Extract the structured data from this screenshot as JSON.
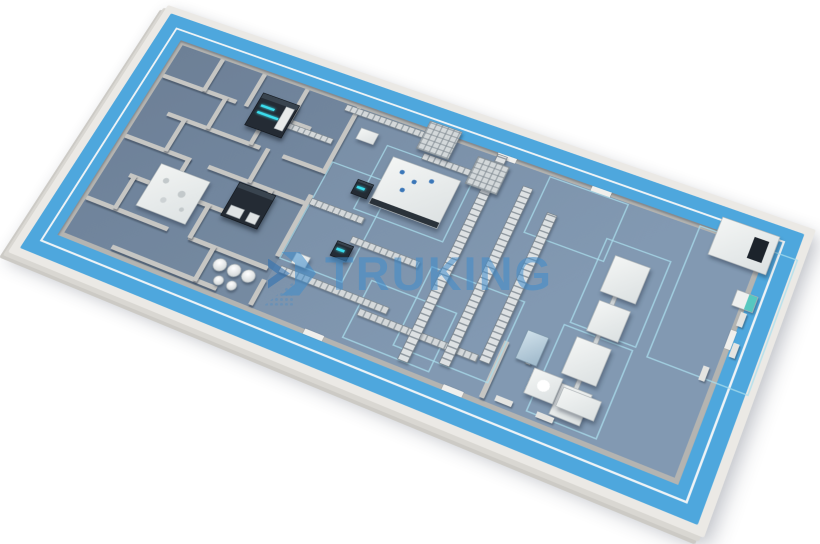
{
  "watermark": {
    "text": "TRUKING",
    "logo_icon": "truking-logo-icon"
  },
  "colors": {
    "walkway": "#4ea7dd",
    "floor-light": "#8299b2",
    "floor-dark": "#74889f",
    "slab": "#ebe9e5",
    "wall": "#c6c6c3",
    "machine-white": "#eef0ef",
    "machine-dark": "#242b34",
    "accent-cyan": "#3bdcec",
    "marking": "#a9ddec",
    "steel": "#cdd2d4",
    "watermark": "#3f8ccc"
  },
  "plan": {
    "corners_screen": {
      "nw": [
        168,
        5
      ],
      "ne": [
        816,
        230
      ],
      "sw": [
        8,
        252
      ],
      "se": [
        704,
        538
      ]
    },
    "size": [
      1000,
      455
    ]
  }
}
